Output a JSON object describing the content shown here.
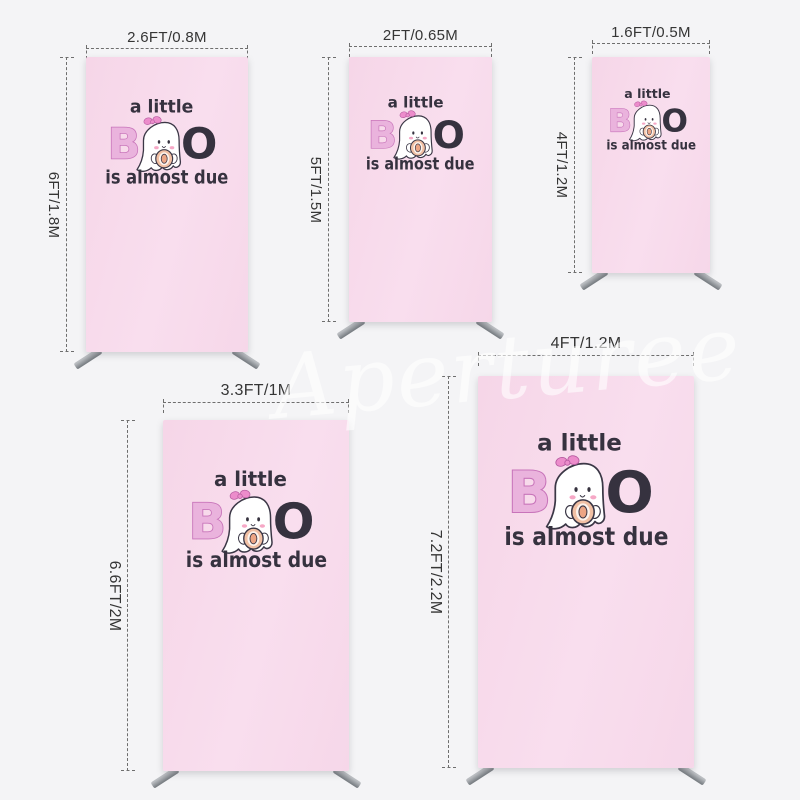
{
  "page": {
    "background": "#f4f4f6"
  },
  "watermark": {
    "text": "Aperturee"
  },
  "design": {
    "line1": "a little",
    "boo_b": "B",
    "boo_o": "O",
    "line3": "is almost due",
    "colors": {
      "fabric_pink": "#f8dbeb",
      "text_dark": "#36323f",
      "letter_pink": "#eab3dd",
      "letter_pink_outline": "#c874ba",
      "bow_pink": "#ec8ccb",
      "ghost_white": "#ffffff",
      "cheek_pink": "#f6a8c6",
      "pacifier_peach": "#f1c0a4",
      "pacifier_center": "#eda584",
      "stand_foot_gray": "#7b8085",
      "dimension_line_gray": "#6e6e6e"
    }
  },
  "stands": [
    {
      "width_label": "2.6FT/0.8M",
      "height_label": "6FT/1.8M"
    },
    {
      "width_label": "2FT/0.65M",
      "height_label": "5FT/1.5M"
    },
    {
      "width_label": "1.6FT/0.5M",
      "height_label": "4FT/1.2M"
    },
    {
      "width_label": "3.3FT/1M",
      "height_label": "6.6FT/2M"
    },
    {
      "width_label": "4FT/1.2M",
      "height_label": "7.2FT/2.2M"
    }
  ]
}
